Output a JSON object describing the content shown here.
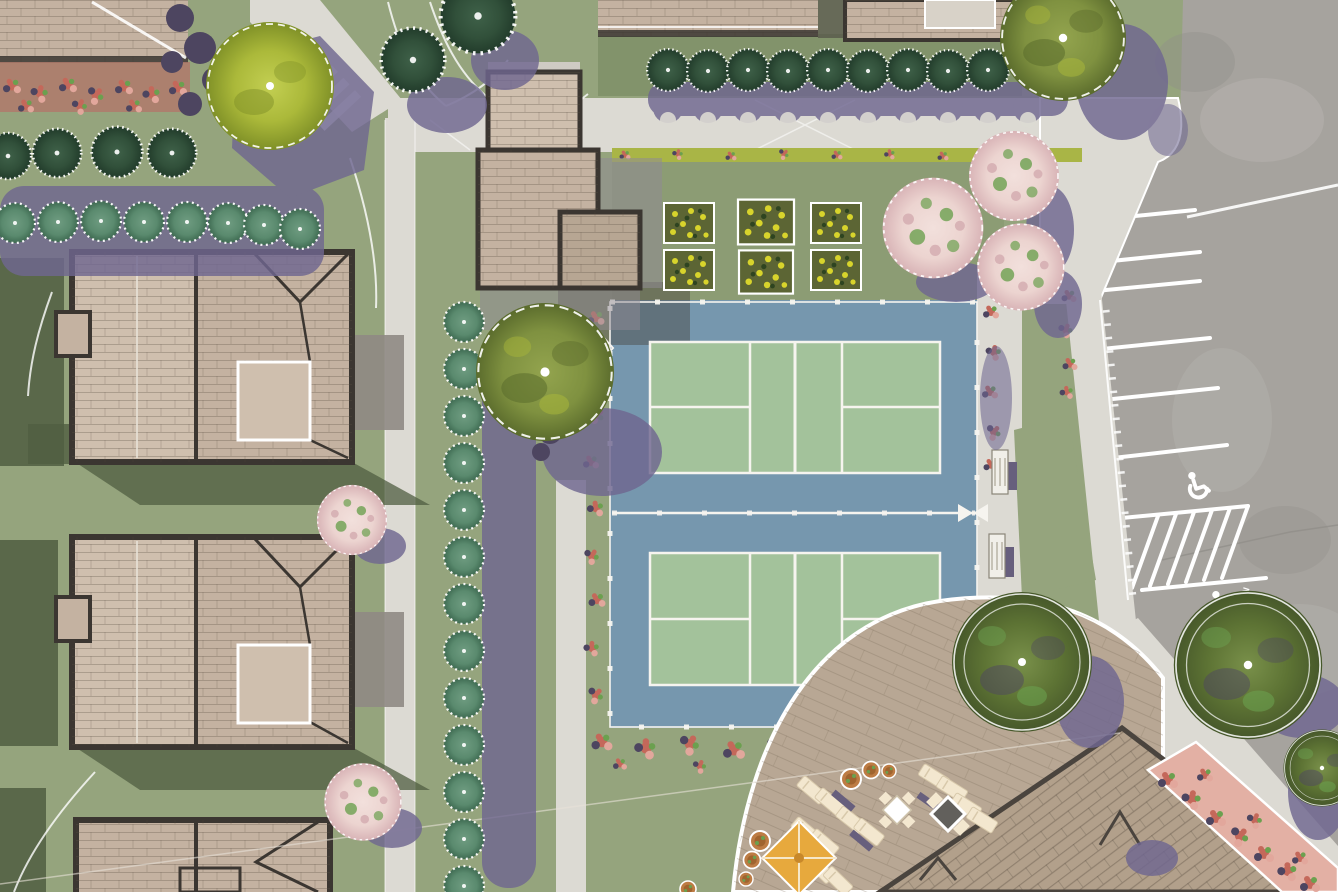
{
  "scene": {
    "title": "Aerial site-plan rendering: residential community with pickleball courts, clubhouse patio and parking",
    "view": "top-down architectural illustration"
  },
  "labels": {
    "van_stall": "VAN"
  },
  "features": {
    "pickleball_courts": 2,
    "townhome_roofs_left": 3,
    "rooftop_buildings_top": 3,
    "pergola_structures": 2,
    "clubhouse_roof": 1,
    "patio_umbrella": 1,
    "patio_loungers": 12,
    "dining_table_sets": 2,
    "benches": 2,
    "accessible_parking_symbols": 2,
    "parking_stall_lines": 6,
    "hedge_shrubs_top_row": 9,
    "hedge_shrubs_left_rows": 12,
    "hedge_shrub_column": 13,
    "flowering_trees": 5,
    "shade_trees": 8,
    "yellow_flower_planters": 6
  },
  "palette": {
    "lawn": "#95a47d",
    "lawnPanel": "#8c9c74",
    "lawnDark": "#7d8e66",
    "lawnShadow": "#505e41",
    "path": "#dcdad3",
    "pathBright": "#e9e7e1",
    "asphalt": "#a6a39e",
    "asphaltLight": "#b7b4af",
    "asphaltDark": "#918e89",
    "white": "#ffffff",
    "courtBlue": "#7697ae",
    "courtGreen": "#a3c29b",
    "fence": "#f6f4ef",
    "roofTan": "#c4b2a1",
    "roofTanLight": "#cfbfae",
    "roofTanDark": "#b7a693",
    "roofEdge": "#3b3631",
    "roofBig": "#b2a08b",
    "concrete": "#8f8a84",
    "grayShadow": "#8f8a93",
    "darkOverlay": "#4a4540",
    "shadowPurple": "#6f6791",
    "shadowPurpleDark": "#4d4560",
    "shrubDark": "#31503a",
    "shrubDarkEdge": "#223c2b",
    "shrubDarkLight": "#3f6149",
    "shrubTeal": "#5a8a6e",
    "shrubTealDark": "#3f6b52",
    "shrubTealLight": "#6f9c81",
    "treeLime": "#abb93a",
    "treeLimeDark": "#7f9027",
    "treeLimeLight": "#c3cf52",
    "treeOlive": "#7f9140",
    "treeOliveDark": "#5a6b2c",
    "treeOliveLight": "#93a44e",
    "treeForest": "#5d7334",
    "treeForestDark": "#46572a",
    "treeForestLight": "#79904a",
    "treePink": "#ecd4d0",
    "treePinkDeep": "#d8b3b6",
    "treePinkLight": "#f2e0dc",
    "leafGreen": "#6ba04f",
    "flowerRed": "#c4685a",
    "flowerPink": "#e2a79c",
    "flowerStrip": "#a9b546",
    "flowerBedBase": "#b07a6b",
    "flowerYellow": "#d8d42c",
    "planterBase": "#5c6534",
    "patio": "#b8a794",
    "cream": "#f3e7cf",
    "furnPurple": "#675f7d",
    "umbrella": "#e7a93d",
    "umbrellaDark": "#c8882a",
    "benchFace": "#f1efe9",
    "benchDark": "#5b5550",
    "potClay": "#bd7c44",
    "potClayDark": "#a0642f"
  }
}
